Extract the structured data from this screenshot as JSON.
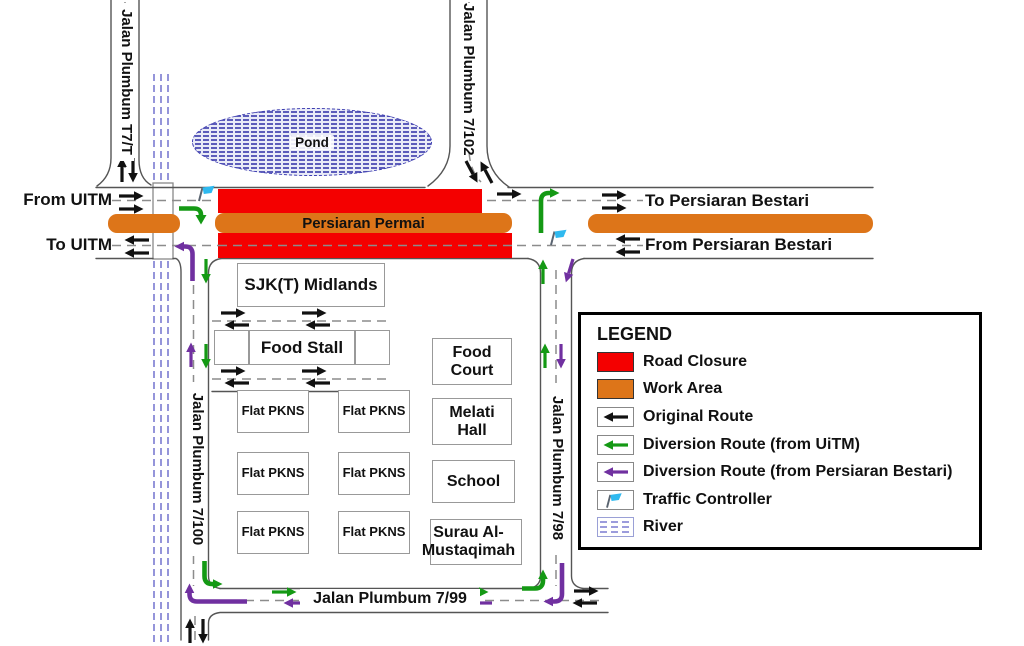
{
  "colors": {
    "road_closure": "#F40000",
    "work_area": "#DD7519",
    "original": "#111111",
    "uitm": "#149914",
    "bestari": "#7030A0",
    "traffic_controller": "#2FB9EF",
    "river": "#7B7BD1",
    "road_line": "#555555",
    "center_line": "#8C8C8C"
  },
  "map": {
    "labels": {
      "from_uitm": "From UITM",
      "to_uitm": "To UITM",
      "to_persiaran_bestari": "To Persiaran Bestari",
      "from_persiaran_bestari": "From Persiaran Bestari",
      "persiaran_permai": "Persiaran Permai",
      "pond": "Pond"
    },
    "roads": {
      "t7t": "Jalan Plumbum T7/T",
      "r7102": "Jalan Plumbum 7/102",
      "r7100": "Jalan Plumbum 7/100",
      "r798": "Jalan Plumbum 7/98",
      "r799": "Jalan Plumbum 7/99"
    },
    "buildings": {
      "sjk": "SJK(T) Midlands",
      "food_stall": "Food Stall",
      "food_court": "Food Court",
      "melati_hall": "Melati Hall",
      "school": "School",
      "surau": "Surau Al-Mustaqimah",
      "flats": [
        "Flat PKNS",
        "Flat PKNS",
        "Flat PKNS",
        "Flat PKNS",
        "Flat PKNS",
        "Flat PKNS"
      ]
    }
  },
  "legend": {
    "title": "LEGEND",
    "items": [
      {
        "key": "road_closure",
        "label": "Road Closure"
      },
      {
        "key": "work_area",
        "label": "Work Area"
      },
      {
        "key": "original_route",
        "label": "Original Route"
      },
      {
        "key": "diversion_uitm",
        "label": "Diversion Route (from UiTM)"
      },
      {
        "key": "diversion_bestari",
        "label": "Diversion Route (from Persiaran Bestari)"
      },
      {
        "key": "traffic_controller",
        "label": "Traffic Controller"
      },
      {
        "key": "river",
        "label": "River"
      }
    ]
  }
}
